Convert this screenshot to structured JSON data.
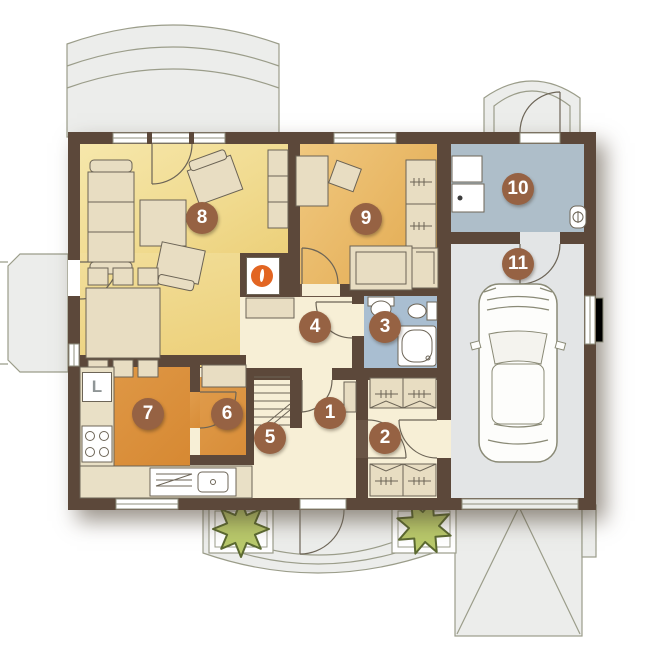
{
  "plan_title": "house ground floor plan",
  "rooms": [
    {
      "number": "1"
    },
    {
      "number": "2"
    },
    {
      "number": "3"
    },
    {
      "number": "4"
    },
    {
      "number": "5"
    },
    {
      "number": "6"
    },
    {
      "number": "7"
    },
    {
      "number": "8"
    },
    {
      "number": "9"
    },
    {
      "number": "10"
    },
    {
      "number": "11"
    }
  ],
  "labels": {
    "fridge": "L"
  },
  "palette": {
    "wall": "#5c483a",
    "living": "#f1dc92",
    "bedroom": "#e5ae54",
    "kitchen": "#d5862f",
    "bathroom": "#a9bed1",
    "utility": "#aebec9",
    "garage": "#e3e5e6",
    "hall": "#f7efd6",
    "outdoor": "#ecedeb",
    "marker": "#966243",
    "plant": "#b9c96b",
    "flame": "#e26522",
    "furniture": "#e8ddc2"
  }
}
